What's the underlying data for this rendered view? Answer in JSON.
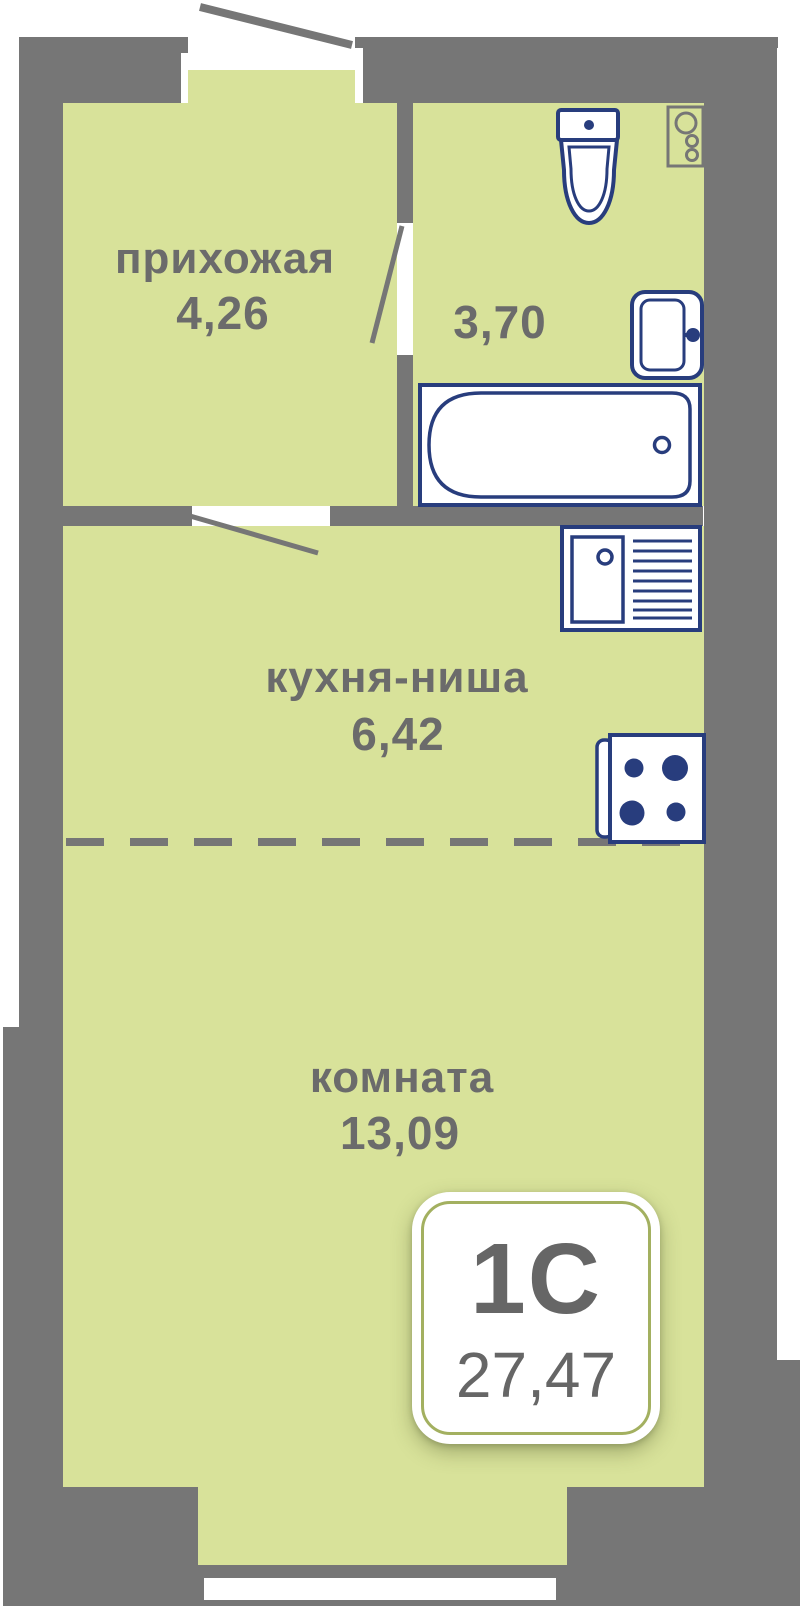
{
  "plan": {
    "title": "studio apartment floor plan",
    "rooms": [
      {
        "id": "hallway",
        "label": "прихожая",
        "area": "4,26"
      },
      {
        "id": "bathroom",
        "label": "",
        "area": "3,70"
      },
      {
        "id": "kitchen",
        "label": "кухня-ниша",
        "area": "6,42"
      },
      {
        "id": "living",
        "label": "комната",
        "area": "13,09"
      }
    ],
    "badge": {
      "unit_type": "1С",
      "total_area": "27,47"
    },
    "icons": [
      "toilet-icon",
      "washing-machine-icon",
      "wash-basin-icon",
      "bathtub-icon",
      "kitchen-sink-icon",
      "stove-icon"
    ],
    "colors": {
      "floor": "#d8e29a",
      "wall": "#767676",
      "fixture_outline": "#283d7d",
      "label_text": "#6b6b6b",
      "badge_text": "#666666",
      "badge_border": "#a3b060"
    }
  }
}
